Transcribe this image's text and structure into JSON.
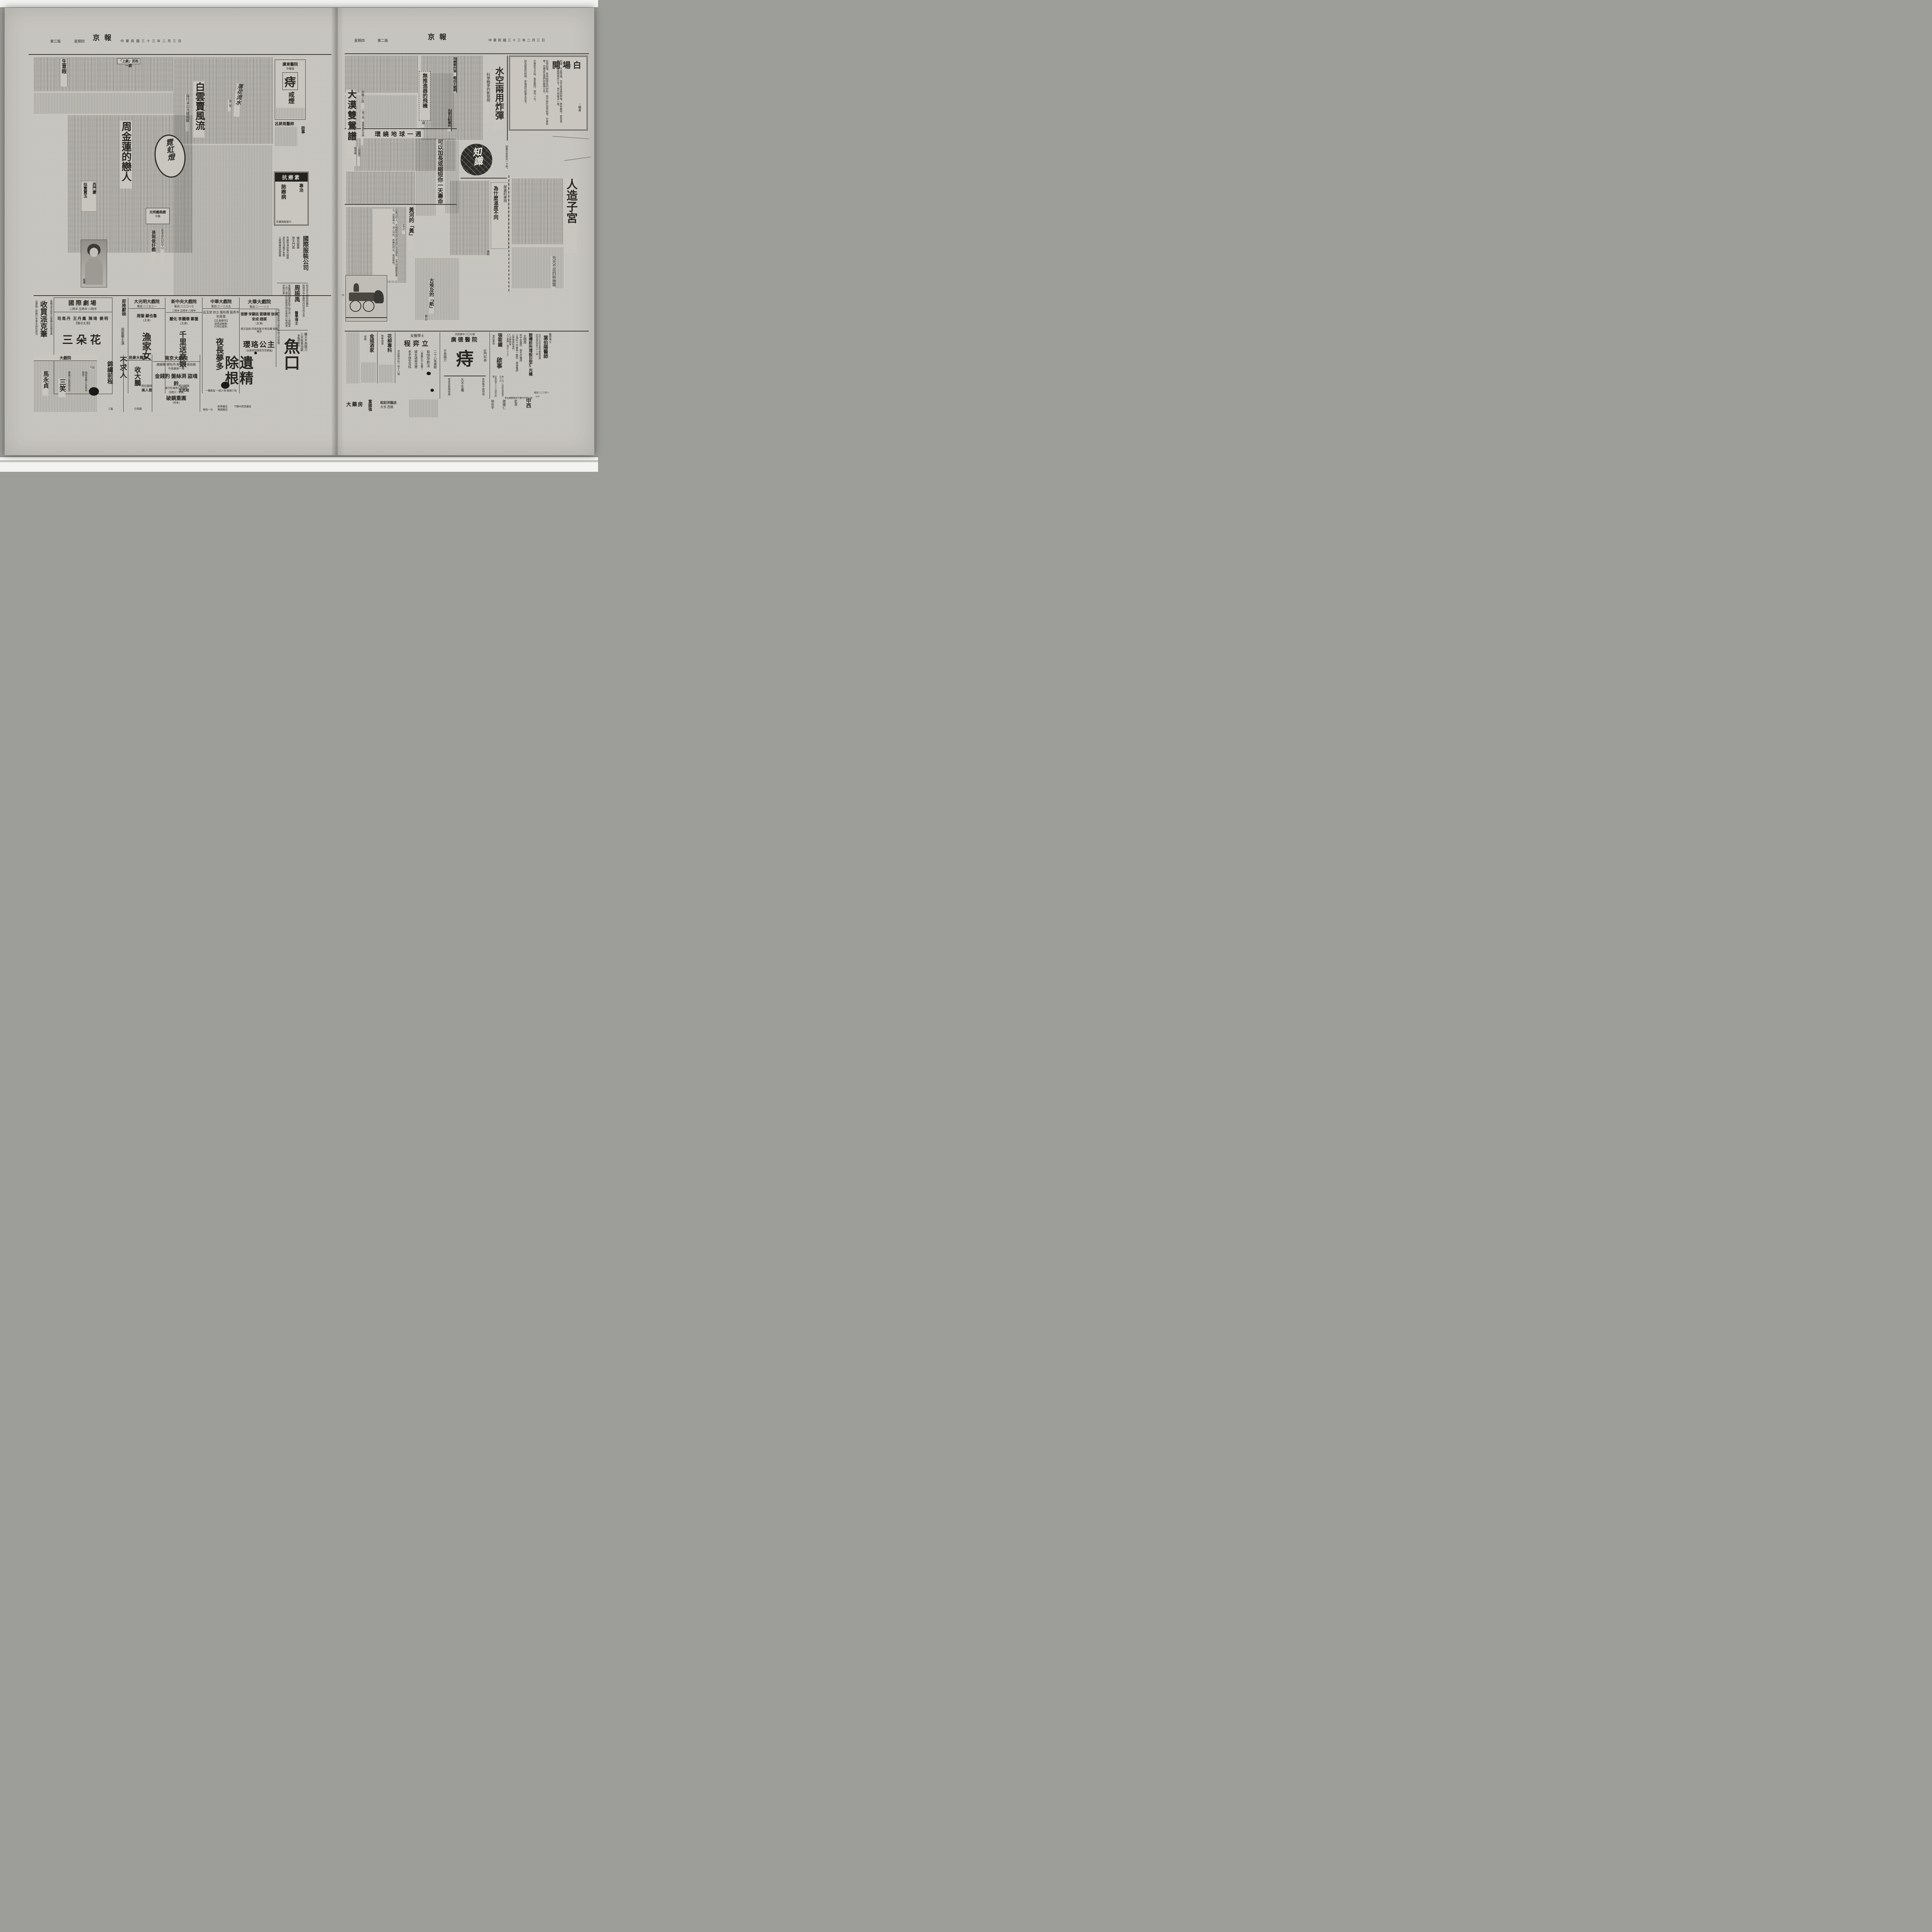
{
  "palette": {
    "paper": "#c8c6bf",
    "ink": "#2b2a27",
    "scanner": "#9d9d99",
    "strip": "#f3f3f1"
  },
  "left_page": {
    "masthead": {
      "edition": "第三版",
      "weekday": "星期四",
      "title": "京報",
      "date": "中華民國三十三年二月三日"
    },
    "biz_eye": {
      "title": "生意眼"
    },
    "wusong": {
      "title": "「上劇」武松一劇"
    },
    "baiyun": {
      "title": "白雲賣風流",
      "subtitle": "羅玲演出洗鍊細膩",
      "calligraphy": "落花流水",
      "chapter": "第二章"
    },
    "zhou": {
      "title": "周金蓮的戀人",
      "seal": "霓虹燈",
      "sub_a": "西門慶",
      "sub_b": "似賣寶玉",
      "note_a": "光明義務戲",
      "note_b": "今晚",
      "kicker": "藝承恩仇記中心",
      "feature": "張琬做好戲",
      "photo_caption": "鳳廔"
    },
    "ads": {
      "zhi": {
        "name": "廣東醫院",
        "addr": "中華路",
        "big": "痔",
        "big2": "戒煙"
      },
      "lv": {
        "name": "呂屏周醫師",
        "notice": "啟事"
      },
      "kang": {
        "brand": "抗癆素",
        "l1": "專治",
        "l2": "肺癆病",
        "l3": "針藥兩廠發行"
      },
      "parker": {
        "big": "收買派克筆",
        "r": "各種派克自來水筆願出高價收買",
        "l": "山東路二郎廟口中華文具社接洽"
      },
      "clothing": {
        "name": "國際服裝公司",
        "s1": "擴充營業",
        "s2": "放大門面",
        "s3": "馬褲呢海勃龍大總匯",
        "s4": "貨色充沛獨步金陵",
        "s5": "工精價廉拾我莫屬"
      },
      "doctor": {
        "name": "周振禹",
        "degree": "醫學博士",
        "c1": "前北京大總統府醫官",
        "c2": "前南京中央醫院內科兒科主任",
        "body": "本醫師現因要事赴平由元月二十號起至二月三號止診務暫停特此奉報以免病者空勞往返"
      },
      "yukou": {
        "big": "魚口",
        "l1": "體大不用開刀",
        "l2": "三天負責消散",
        "l3": "李醫師專科"
      },
      "yijing": {
        "big": "遺精除根",
        "l1": "每粒一元",
        "l2": "萬國藥房",
        "l3": "新華藥房",
        "l4": "下關中西堂藥房"
      }
    },
    "theaters": [
      {
        "name": "國際劇場",
        "times": "二時半 五時半 八時半",
        "cast": "司馬丹 王丹鳳 陳琦 姜明",
        "castnote": "【聯合主演】",
        "film": "三朵花",
        "tag1": "暴露少年罪惡白史",
        "tag2": "描寫虛榮少女失足恨史"
      },
      {
        "label": "即將獻映",
        "star": "周曼華主演",
        "film": "不求人"
      },
      {
        "name": "大光明大戲院",
        "phone": "電話:二二五三一",
        "cast": "周璇 顧也魯",
        "castnote": "(主演)",
        "film": "漁家女",
        "next": "明日獻映",
        "nextfilm": "美人恩"
      },
      {
        "name": "新中央大戲院",
        "phone": "電話:二三〇八七",
        "times": "二時半 五時半 八時半",
        "cast": "嚴化 李麗華 鄭重",
        "castnote": "(主演)",
        "film": "千里送京娘",
        "next": "明日獻映",
        "nextfilm": "生死劫"
      },
      {
        "name": "中華大戲院",
        "phone": "電話:三一二九五",
        "times": "二時半 五時半 八時半",
        "cast": "呂玉堃 徐立 龔秋霞 殷秀岑 利青雲",
        "castnote": "【主演傑作】",
        "tag1": "哭得淚無算!",
        "tag2": "打得比還苦!",
        "film": "夜長夢多",
        "foot": "一種典型 一個人物 銀壇少有"
      },
      {
        "name": "大華大戲院",
        "phone": "電話:二一一八三",
        "times": "二時半 五時半 八時半",
        "cast": "張靜 李顯廷 劉聰潮 徐琪 安成 趙撰",
        "castnote": "(主演)",
        "tags": "國王誕辰 四海來朝 珍奇炫耀 窮極奢侈",
        "film": "瓔珞公主",
        "foot": "(古裝神話媲美月宮寶盒)",
        "side": "中華電影聯合股份有限公司管理"
      },
      {
        "name": "南京大戲院",
        "cast": "趙韻聲 銀牡丹 粉牡丹 張如庭",
        "line": "今夜最後一場",
        "films": "金錢豹 盤絲洞 盜魂鈴",
        "note": "連日狂滿請火速定座",
        "day": "日戲又一鉅劇",
        "dayfilm": "破鏡重圓",
        "daynote": "(四本)"
      },
      {
        "name": "民衆大舞台",
        "film": "收大鵬",
        "line": "日夜戲"
      },
      {
        "film": "錦繡前程",
        "note": "三集"
      },
      {
        "name": "大戲院",
        "film_a": "馬永貞",
        "film_b": "三笑",
        "line": "今起"
      }
    ]
  },
  "right_page": {
    "masthead": {
      "weekday": "星期四",
      "edition": "第二版",
      "title": "京報",
      "date": "中華民國三十三年二月三日"
    },
    "opening": {
      "title": "開場白",
      "byline": "・編者",
      "p1": "知識，不是常識，也不是深奧的學理，要有趣味，要有意義，在這幾個條件之下，努力培植這一版。",
      "p2": "科學知識，是本版特有的材料，但不限於自然科學，社會科學，也應該在我們的範圍以內。",
      "p3": "打算從今天起，每星期四，發刊一次。",
      "p4": "因為版面的限制，來稿請勿超過五百字。"
    },
    "bomb": {
      "title": "水空兩用炸彈",
      "kicker": "科學戰爭的新發明",
      "sub1": "飛機懸炸彈 織成天羅網",
      "sub2": "魚雷自動爆炸"
    },
    "jet": {
      "title": "無推進器的飛機",
      "byline": "遲"
    },
    "globe": {
      "title": "環繞地球一週"
    },
    "novel": {
      "genre": "俠情小說",
      "title": "大漠雙鴛譜",
      "author": "王度廬作",
      "artist": "鏡海繪",
      "chapter": "第一章 風雲裏的兄妹"
    },
    "lifespan": {
      "title": "可以加長或縮短你一天壽命"
    },
    "logo": {
      "text": "知識"
    },
    "note": "頭腦也來研究一下吧。",
    "temperature": {
      "kicker": "屋裏的東西",
      "title": "為什麼溫度不同",
      "byline": "博鈞"
    },
    "womb": {
      "title": "人造子宮",
      "kicker": "先天不足的新施策"
    },
    "river": {
      "title": "黃河的「黃」",
      "byline": "玄之",
      "excerpt": "近黃河的人，大概都知道它是由於含泥過多、北方到處都是黃土，這些黃土，流入河內，將無色的水，染成黃色。"
    },
    "papyrus": {
      "title": "古埃及的「紙」",
      "byline": "春谷"
    },
    "illus_mark": "16",
    "ads": {
      "guangde": {
        "addr": "洪武路中二〇七號",
        "name": "廣德醫院",
        "big": "痔",
        "dept": "肛門科病",
        "l1": "不用開刀",
        "l2": "有財無子縱何用",
        "l3": "久不生養",
        "l4": "老來受欺悔恨遲"
      },
      "cheng": {
        "degree": "女醫學士",
        "name": "程弈立",
        "e1": "二十八年實驗",
        "e2": "有快孕新法",
        "e3": "△專醫久不生養▽",
        "e4": "婦女諸病流帶",
        "e5": "老手接生兒科",
        "addr": "洪武路中段一百十八號"
      },
      "huali": {
        "name": "花柳專科",
        "l1": "梅毒淋濁"
      },
      "jincheng": {
        "name": "金城酒家",
        "l1": "客飯"
      },
      "xray": {
        "name": "鼓樓診所增設巨型X光機",
        "lamp": "太陽燈",
        "d1": "前中央醫院 楊光杰醫師",
        "d2": "上海紅十字會第一醫院 陳偉醫師",
        "s1": "心肺肺癆科專門",
        "s2": "X光肺檢查",
        "s3": "人工氣胸(每次三十元)",
        "addr": "地址建鄴路鴿子橋竹竿里九號"
      },
      "zhang": {
        "name": "張筱鐵",
        "craft": "金石篆刻",
        "big": "啟事",
        "p1": "自一月一日起石質每字五十元",
        "p2": "牙質每字八十元四字起算",
        "p3": "外埠來件郵費自理另加二成",
        "p4": "寓南京貢院西街夫子廟口大陸茶房內"
      },
      "ye": {
        "degree": "醫學博士",
        "name": "葉伯陽醫師",
        "scope": "內科小兒科花柳科兼擅戒煙",
        "addr": "診所遊府西街六十一號",
        "phone": "電話二二三四八",
        "code": "A30",
        "tag": "中西"
      },
      "shops": {
        "a": "大藥房",
        "b": "富國強",
        "c": "松記洋服店",
        "c2": "大衣 西裝",
        "d": "徐志平",
        "e": "謝維仁",
        "f": "史濟",
        "g": "中西"
      }
    }
  }
}
